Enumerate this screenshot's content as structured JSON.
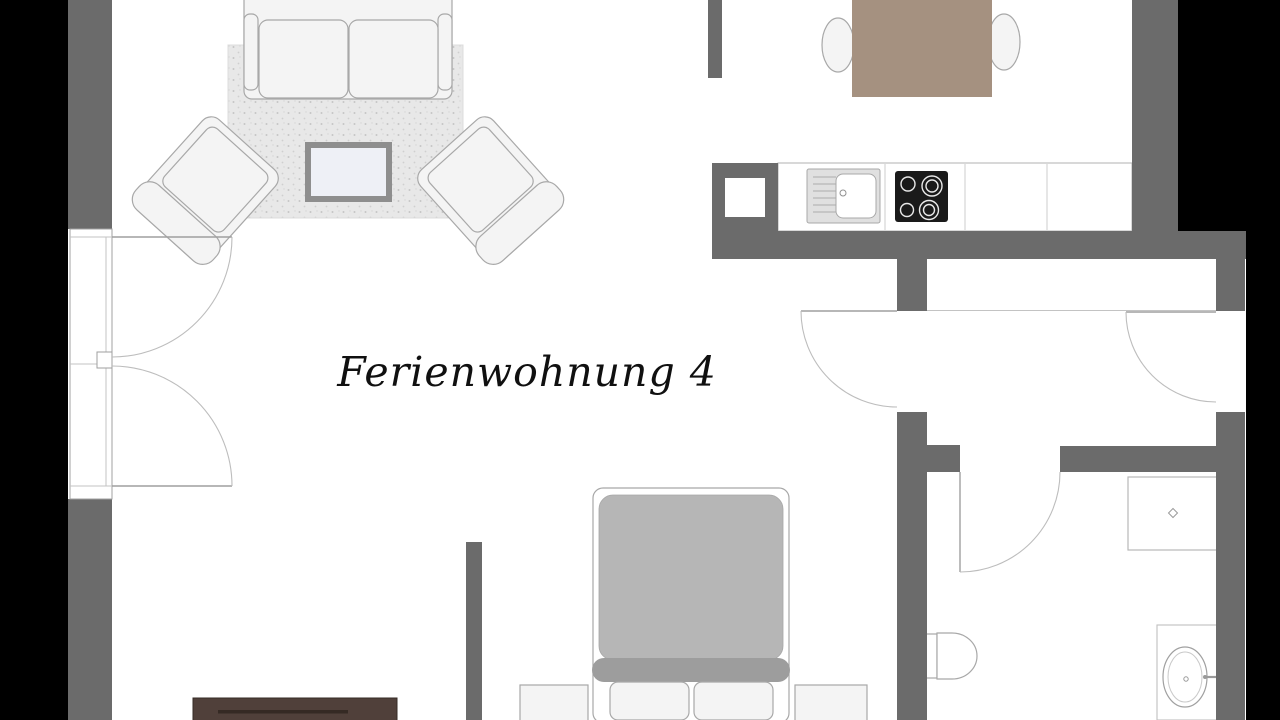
{
  "title": {
    "text": "Ferienwohnung 4"
  },
  "palette": {
    "background": "#000000",
    "floor": "#ffffff",
    "wall": "#6b6b6b",
    "furniture_fill": "#f4f4f4",
    "furniture_outline": "#a8a8a8",
    "rug": "#e8e8e8",
    "duvet": "#b6b6b6",
    "bed_band": "#9d9d9d",
    "dining_table": "#a59180",
    "sideboard": "#50403a",
    "cooktop": "#1a1a1a",
    "sink": "#e0e0e0",
    "coffee_table_frame": "#8e8e8e",
    "coffee_table_top": "#eef0f6"
  },
  "floorplan": {
    "type": "apartment-floor-plan",
    "areas": [
      {
        "name": "living-area",
        "furniture": [
          "two-seat-sofa",
          "rug",
          "coffee-table",
          "armchair-left",
          "armchair-right",
          "tv-sideboard"
        ]
      },
      {
        "name": "sleeping-area",
        "furniture": [
          "double-bed",
          "pillow-left",
          "pillow-right",
          "nightstand-left",
          "nightstand-right"
        ]
      },
      {
        "name": "kitchen-dining",
        "furniture": [
          "kitchen-counter",
          "kitchen-sink",
          "cooktop",
          "dining-table",
          "dining-chair-left",
          "dining-chair-right"
        ]
      },
      {
        "name": "hallway",
        "furniture": []
      },
      {
        "name": "bathroom",
        "furniture": [
          "shower",
          "toilet",
          "washbasin-vanity"
        ]
      }
    ],
    "doors": [
      "french-double-door-left",
      "living-to-hall-door",
      "entrance-door-right",
      "bathroom-door"
    ]
  }
}
